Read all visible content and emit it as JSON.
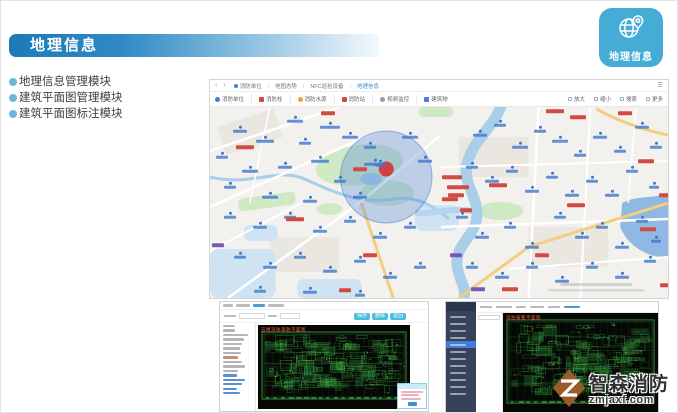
{
  "slide": {
    "banner_title": "地理信息",
    "bullets": [
      "地理信息管理模块",
      "建筑平面图管理模块",
      "建筑平面图标注模块"
    ],
    "app_icon": {
      "label": "地理信息",
      "color": "#45acd5",
      "icon": "globe-pin-icon"
    }
  },
  "map_app": {
    "nav": {
      "back": "‹",
      "forward": "›",
      "sep": "|",
      "menu_icon": "☰",
      "breadcrumb": [
        {
          "label": "消防单位",
          "active": false,
          "icon": "user-icon"
        },
        {
          "label": "地图态势",
          "active": false
        },
        {
          "label": "NFC巡检设备",
          "active": false
        },
        {
          "label": "地理信息",
          "active": true
        }
      ]
    },
    "layers": [
      {
        "label": "消防单位",
        "color": "#3f7fd8",
        "shape": "circle",
        "icon": "user-icon"
      },
      {
        "label": "消防栓",
        "color": "#d24a3e",
        "shape": "square",
        "icon": "hydrant-icon"
      },
      {
        "label": "消防水源",
        "color": "#f0a032",
        "shape": "circle",
        "icon": "water-source-icon"
      },
      {
        "label": "消防站",
        "color": "#d24a3e",
        "shape": "square",
        "icon": "fire-station-icon"
      },
      {
        "label": "视频监控",
        "color": "#8f9dab",
        "shape": "circle",
        "icon": "camera-icon"
      },
      {
        "label": "建筑物",
        "color": "#3f7fd8",
        "shape": "square",
        "icon": "building-icon"
      }
    ],
    "view_controls": [
      {
        "label": "放大",
        "icon": "zoom-in-icon"
      },
      {
        "label": "缩小",
        "icon": "zoom-out-icon"
      },
      {
        "label": "搜索",
        "icon": "search-icon"
      },
      {
        "label": "更多",
        "icon": "more-icon"
      }
    ],
    "zone_color": "rgba(86,137,215,0.34)",
    "alarm_marker_color": "#d24040",
    "markers": [
      [
        85,
        12,
        "b",
        16
      ],
      [
        120,
        18,
        "b",
        20
      ],
      [
        30,
        22,
        "b",
        14
      ],
      [
        55,
        32,
        "b",
        18
      ],
      [
        95,
        34,
        "b",
        12
      ],
      [
        140,
        28,
        "b",
        16
      ],
      [
        12,
        48,
        "b",
        12
      ],
      [
        40,
        62,
        "b",
        16
      ],
      [
        75,
        58,
        "b",
        14
      ],
      [
        110,
        52,
        "b",
        18
      ],
      [
        160,
        38,
        "b",
        12
      ],
      [
        200,
        28,
        "b",
        16
      ],
      [
        215,
        52,
        "b",
        14
      ],
      [
        20,
        78,
        "b",
        12
      ],
      [
        60,
        88,
        "b",
        16
      ],
      [
        130,
        72,
        "b",
        12
      ],
      [
        150,
        88,
        "b",
        14
      ],
      [
        170,
        56,
        "b",
        10
      ],
      [
        100,
        92,
        "b",
        14
      ],
      [
        165,
        55,
        "b",
        22
      ],
      [
        35,
        40,
        "r",
        18
      ],
      [
        118,
        6,
        "r",
        14
      ],
      [
        242,
        70,
        "r",
        20
      ],
      [
        248,
        80,
        "r",
        22
      ],
      [
        246,
        88,
        "r",
        16
      ],
      [
        150,
        62,
        "r",
        14
      ],
      [
        270,
        26,
        "b",
        14
      ],
      [
        290,
        16,
        "b",
        12
      ],
      [
        310,
        38,
        "b",
        16
      ],
      [
        330,
        22,
        "b",
        12
      ],
      [
        350,
        32,
        "b",
        16
      ],
      [
        370,
        46,
        "b",
        12
      ],
      [
        390,
        28,
        "b",
        14
      ],
      [
        410,
        42,
        "b",
        12
      ],
      [
        432,
        18,
        "b",
        14
      ],
      [
        446,
        38,
        "b",
        12
      ],
      [
        262,
        58,
        "b",
        12
      ],
      [
        282,
        72,
        "b",
        14
      ],
      [
        302,
        62,
        "b",
        12
      ],
      [
        322,
        82,
        "b",
        14
      ],
      [
        342,
        68,
        "b",
        12
      ],
      [
        362,
        86,
        "b",
        14
      ],
      [
        382,
        72,
        "b",
        12
      ],
      [
        402,
        86,
        "b",
        14
      ],
      [
        422,
        62,
        "b",
        12
      ],
      [
        444,
        78,
        "b",
        10
      ],
      [
        345,
        4,
        "r",
        18
      ],
      [
        368,
        10,
        "r",
        16
      ],
      [
        415,
        6,
        "r",
        14
      ],
      [
        436,
        54,
        "r",
        16
      ],
      [
        288,
        78,
        "r",
        18
      ],
      [
        240,
        92,
        "r",
        16
      ],
      [
        455,
        88,
        "r",
        12
      ],
      [
        252,
        108,
        "b",
        12
      ],
      [
        272,
        128,
        "b",
        14
      ],
      [
        300,
        118,
        "b",
        12
      ],
      [
        322,
        138,
        "b",
        14
      ],
      [
        350,
        108,
        "b",
        12
      ],
      [
        372,
        128,
        "b",
        14
      ],
      [
        392,
        118,
        "b",
        12
      ],
      [
        412,
        138,
        "b",
        14
      ],
      [
        432,
        112,
        "b",
        12
      ],
      [
        446,
        132,
        "b",
        10
      ],
      [
        262,
        158,
        "b",
        12
      ],
      [
        292,
        168,
        "b",
        14
      ],
      [
        322,
        158,
        "b",
        12
      ],
      [
        352,
        172,
        "b",
        14
      ],
      [
        382,
        158,
        "b",
        12
      ],
      [
        412,
        168,
        "b",
        14
      ],
      [
        440,
        152,
        "b",
        12
      ],
      [
        300,
        182,
        "r",
        16
      ],
      [
        332,
        148,
        "r",
        14
      ],
      [
        366,
        98,
        "r",
        18
      ],
      [
        438,
        122,
        "r",
        16
      ],
      [
        256,
        103,
        "r",
        12
      ],
      [
        268,
        182,
        "p",
        14
      ],
      [
        246,
        148,
        "p",
        12
      ],
      [
        20,
        108,
        "b",
        12
      ],
      [
        50,
        118,
        "b",
        14
      ],
      [
        80,
        108,
        "b",
        12
      ],
      [
        110,
        122,
        "b",
        14
      ],
      [
        140,
        112,
        "b",
        12
      ],
      [
        170,
        128,
        "b",
        14
      ],
      [
        200,
        118,
        "b",
        12
      ],
      [
        30,
        148,
        "b",
        12
      ],
      [
        60,
        158,
        "b",
        14
      ],
      [
        90,
        148,
        "b",
        12
      ],
      [
        120,
        162,
        "b",
        14
      ],
      [
        150,
        152,
        "b",
        12
      ],
      [
        180,
        168,
        "b",
        14
      ],
      [
        210,
        158,
        "b",
        12
      ],
      [
        50,
        182,
        "b",
        12
      ],
      [
        100,
        183,
        "b",
        14
      ],
      [
        150,
        186,
        "b",
        10
      ],
      [
        85,
        112,
        "r",
        18
      ],
      [
        160,
        148,
        "r",
        14
      ],
      [
        135,
        183,
        "r",
        12
      ],
      [
        8,
        138,
        "p",
        12
      ],
      [
        455,
        178,
        "r",
        10
      ]
    ]
  },
  "cad_left": {
    "title": "五楼消防疏散平面图",
    "toolbar_buttons": [
      {
        "label": "保存"
      },
      {
        "label": "删除"
      },
      {
        "label": "返回"
      }
    ]
  },
  "cad_right": {
    "title": "消防报警平面图"
  },
  "watermark": {
    "brand": "智森消防",
    "site": "zmjaxf.com",
    "logo_color": "#9a5a2a"
  }
}
